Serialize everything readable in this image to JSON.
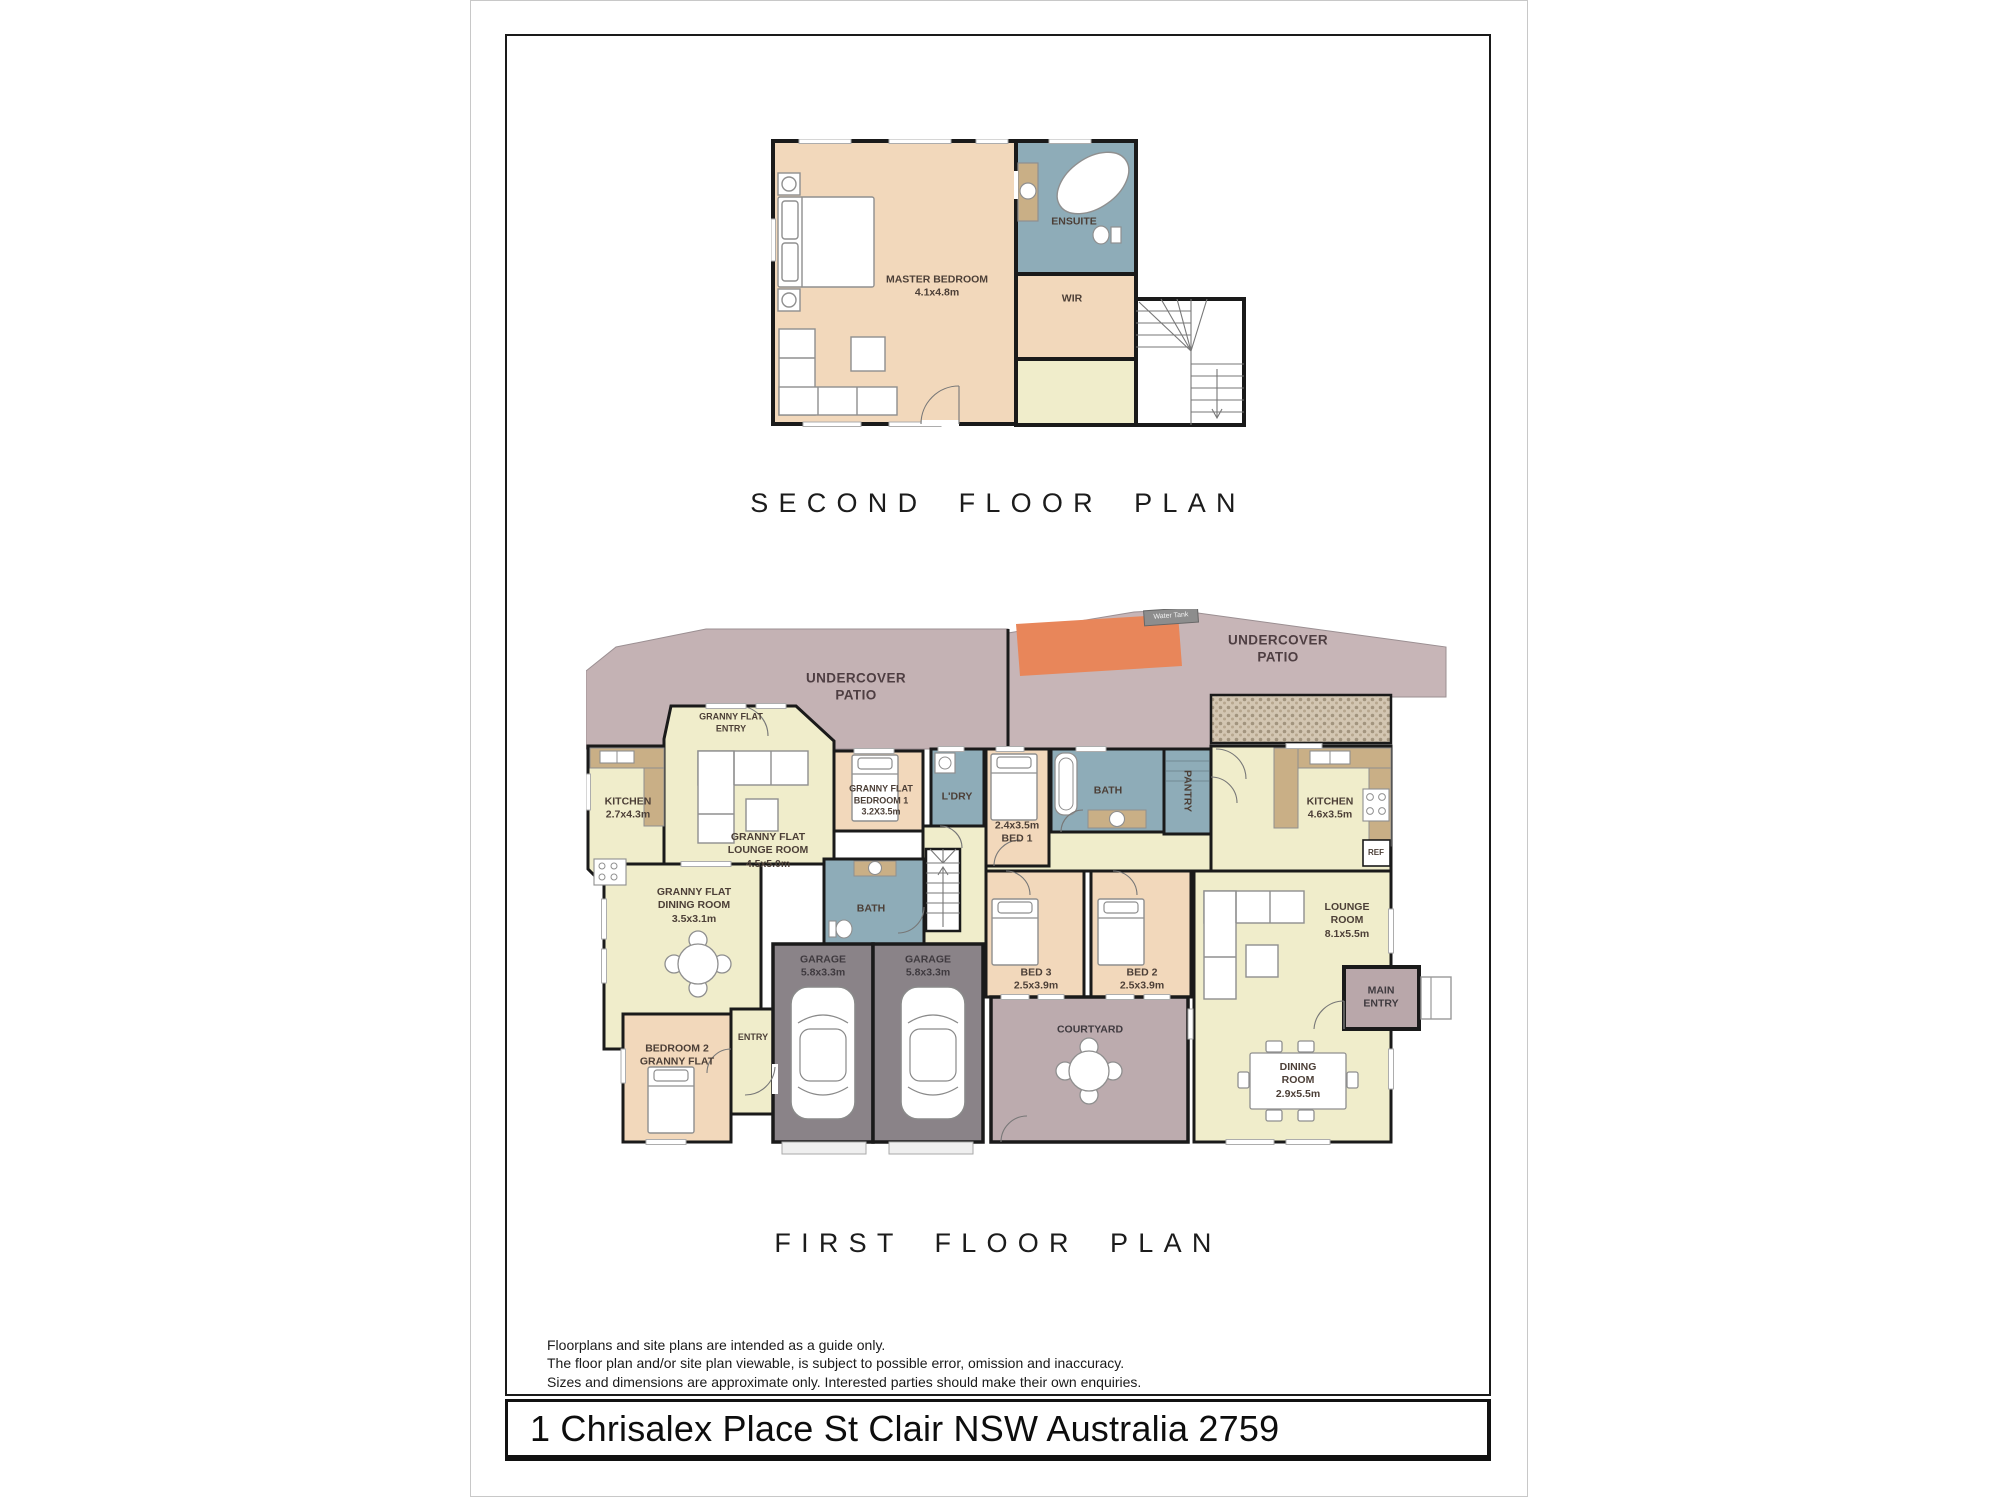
{
  "page": {
    "titles": {
      "second": "SECOND FLOOR PLAN",
      "first": "FIRST FLOOR PLAN"
    },
    "disclaimer": [
      "Floorplans and site plans are intended as a guide only.",
      "The floor plan and/or site plan viewable, is subject to possible error, omission and inaccuracy.",
      "Sizes and dimensions are approximate only. Interested parties should make their own enquiries."
    ],
    "address": "1 Chrisalex Place St Clair NSW Australia 2759"
  },
  "colors": {
    "walls": "#1a1a1a",
    "cream_room": "#f0edcb",
    "peach_room": "#f2d8bb",
    "wet_area_blue": "#8eacb8",
    "patio_mauve": "#c4b2b4",
    "courtyard_mauve": "#bcabae",
    "garage_grey": "#8a8388",
    "shade_orange": "#e8865a",
    "bench_tan": "#c9af86"
  },
  "second_floor": {
    "master_bedroom": {
      "label": "MASTER BEDROOM",
      "dim": "4.1x4.8m"
    },
    "ensuite": {
      "label": "ENSUITE"
    },
    "wir": {
      "label": "WIR"
    }
  },
  "first_floor": {
    "patio_left": {
      "line1": "UNDERCOVER",
      "line2": "PATIO"
    },
    "patio_right": {
      "line1": "UNDERCOVER",
      "line2": "PATIO"
    },
    "water_tank": {
      "label": "Water Tank"
    },
    "gf_entry": {
      "line1": "GRANNY FLAT",
      "line2": "ENTRY"
    },
    "gf_kitchen": {
      "label": "KITCHEN",
      "dim": "2.7x4.3m"
    },
    "gf_lounge": {
      "line1": "GRANNY FLAT",
      "line2": "LOUNGE ROOM",
      "dim": "4.5x5.0m"
    },
    "gf_bedroom1": {
      "line1": "GRANNY FLAT",
      "line2": "BEDROOM 1",
      "dim": "3.2X3.5m"
    },
    "laundry": {
      "label": "L'DRY"
    },
    "bed1": {
      "line1": "2.4x3.5m",
      "line2": "BED 1"
    },
    "bath": {
      "label": "BATH"
    },
    "pantry": {
      "label": "PANTRY"
    },
    "kitchen": {
      "label": "KITCHEN",
      "dim": "4.6x3.5m"
    },
    "ref": {
      "label": "REF"
    },
    "gf_dining": {
      "line1": "GRANNY FLAT",
      "line2": "DINING ROOM",
      "dim": "3.5x3.1m"
    },
    "gf_bath": {
      "label": "BATH"
    },
    "bed3": {
      "label": "BED 3",
      "dim": "2.5x3.9m"
    },
    "bed2": {
      "label": "BED 2",
      "dim": "2.5x3.9m"
    },
    "lounge": {
      "line1": "LOUNGE",
      "line2": "ROOM",
      "dim": "8.1x5.5m"
    },
    "main_entry": {
      "line1": "MAIN",
      "line2": "ENTRY"
    },
    "dining": {
      "line1": "DINING",
      "line2": "ROOM",
      "dim": "2.9x5.5m"
    },
    "courtyard": {
      "label": "COURTYARD"
    },
    "garage_left": {
      "label": "GARAGE",
      "dim": "5.8x3.3m"
    },
    "garage_right": {
      "label": "GARAGE",
      "dim": "5.8x3.3m"
    },
    "gf_bedroom2": {
      "line1": "BEDROOM 2",
      "line2": "GRANNY FLAT"
    },
    "entry": {
      "label": "ENTRY"
    }
  }
}
